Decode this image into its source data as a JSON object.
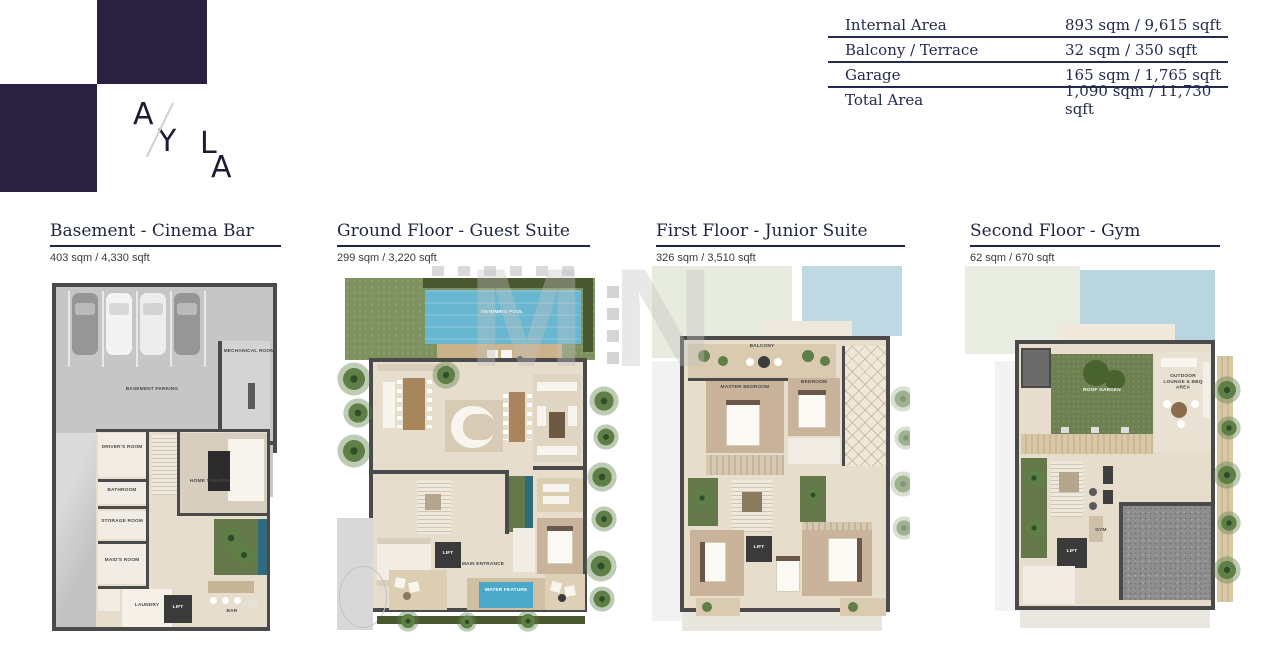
{
  "brand": {
    "letters": [
      "A",
      "Y",
      "L",
      "A"
    ],
    "logo_color": "#2a2040"
  },
  "watermark": {
    "text": "MN"
  },
  "area_table": {
    "rows": [
      {
        "label": "Internal Area",
        "value": "893 sqm / 9,615 sqft"
      },
      {
        "label": "Balcony / Terrace",
        "value": "32 sqm / 350 sqft"
      },
      {
        "label": "Garage",
        "value": "165 sqm / 1,765 sqft"
      },
      {
        "label": "Total Area",
        "value": "1,090 sqm / 11,730 sqft"
      }
    ]
  },
  "floors": [
    {
      "title": "Basement - Cinema Bar",
      "area": "403 sqm / 4,330 sqft"
    },
    {
      "title": "Ground Floor - Guest Suite",
      "area": "299 sqm / 3,220 sqft"
    },
    {
      "title": "First Floor - Junior Suite",
      "area": "326 sqm / 3,510 sqft"
    },
    {
      "title": "Second Floor - Gym",
      "area": "62 sqm / 670 sqft"
    }
  ],
  "plan_labels": {
    "basement": {
      "parking": "BASEMENT PARKING",
      "mechanical": "MECHANICAL ROOM",
      "drivers": "DRIVER'S ROOM",
      "bathroom": "BATHROOM",
      "storage": "STORAGE ROOM",
      "maids": "MAID'S ROOM",
      "laundry": "LAUNDRY",
      "lift": "LIFT",
      "theater": "HOME THEATER",
      "bar": "BAR"
    },
    "ground": {
      "pool": "SWIMMING POOL",
      "main_entrance": "MAIN ENTRANCE",
      "water_feature": "WATER FEATURE",
      "lift": "LIFT"
    },
    "first": {
      "balcony": "BALCONY",
      "master": "MASTER BEDROOM",
      "bedroom": "BEDROOM",
      "lift": "LIFT"
    },
    "second": {
      "roof_garden": "ROOF GARDEN",
      "lounge": "OUTDOOR LOUNGE & BBQ AREA",
      "gym": "GYM",
      "lift": "LIFT"
    }
  },
  "colors": {
    "navy": "#222a4d",
    "logo_purple": "#2a2040",
    "pool_blue": "#68b6cf",
    "lawn_green": "#7e9260",
    "wall_gray": "#4a4a4a",
    "floor_beige": "#e6ddcd"
  }
}
